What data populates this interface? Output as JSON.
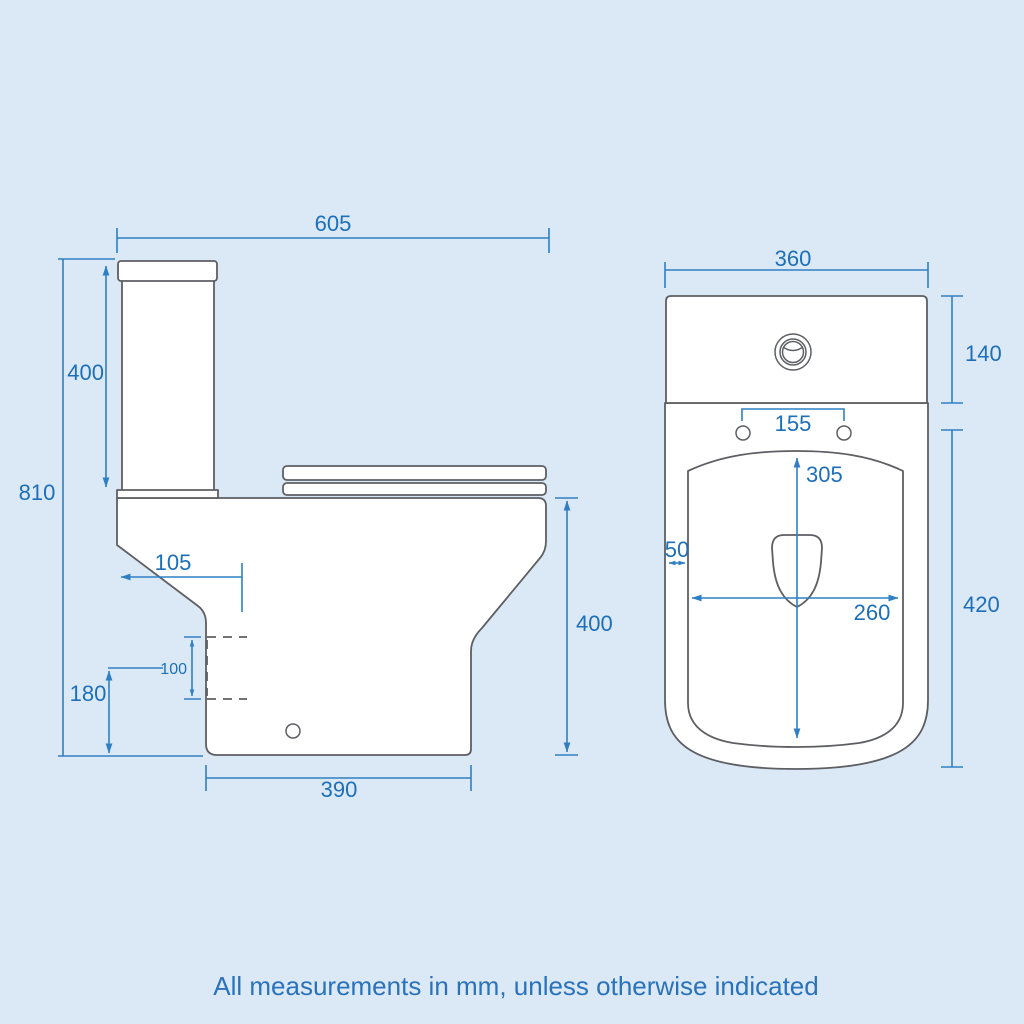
{
  "footer": {
    "note": "All measurements in mm, unless otherwise indicated"
  },
  "colors": {
    "background": "#dbe9f7",
    "object_line": "#5d5f62",
    "dimension_line": "#2f80c3",
    "dimension_text": "#1d6fb8",
    "footer_text": "#2a72b9"
  },
  "side_view": {
    "dims": {
      "overall_depth": "605",
      "cistern_height": "400",
      "overall_height": "810",
      "setback": "105",
      "outlet": "100",
      "outlet_height": "180",
      "base_depth": "390",
      "pan_height": "400"
    }
  },
  "front_view": {
    "dims": {
      "overall_width": "360",
      "cistern_height": "140",
      "hinge_spacing": "155",
      "bowl_depth": "305",
      "rim_width": "50",
      "bowl_width": "260",
      "pan_height": "420"
    }
  }
}
